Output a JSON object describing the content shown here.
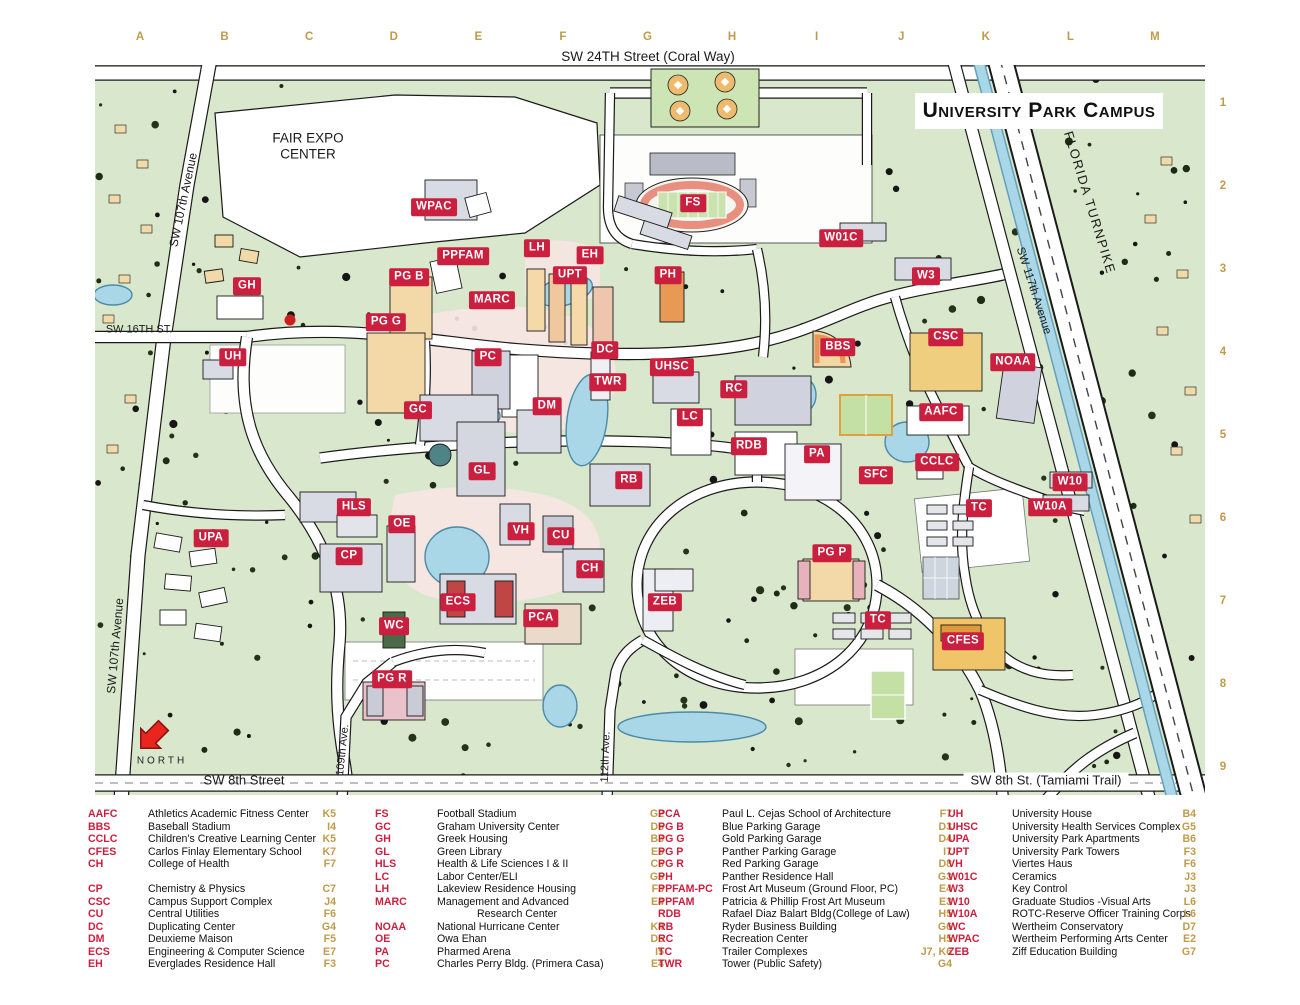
{
  "title_box": "University Park Campus",
  "top_street": "SW 24TH Street (Coral Way)",
  "north": {
    "label": "NORTH"
  },
  "colors": {
    "badge_red": "#cb1f3f",
    "grid_gold": "#bf9b4a",
    "map_green": "#d9e8cc",
    "water": "#a9d7e8",
    "road": "#ffffff"
  },
  "grid": {
    "letters": [
      "A",
      "B",
      "C",
      "D",
      "E",
      "F",
      "G",
      "H",
      "I",
      "J",
      "K",
      "L",
      "M"
    ],
    "numbers": [
      "1",
      "2",
      "3",
      "4",
      "5",
      "6",
      "7",
      "8",
      "9"
    ]
  },
  "map_labels": [
    {
      "t": "WPAC",
      "x": 434,
      "y": 207
    },
    {
      "t": "FS",
      "x": 693,
      "y": 203
    },
    {
      "t": "W01C",
      "x": 841,
      "y": 238
    },
    {
      "t": "LH",
      "x": 537,
      "y": 248
    },
    {
      "t": "PPFAM",
      "x": 463,
      "y": 256
    },
    {
      "t": "EH",
      "x": 590,
      "y": 255
    },
    {
      "t": "UPT",
      "x": 570,
      "y": 275
    },
    {
      "t": "PH",
      "x": 668,
      "y": 275
    },
    {
      "t": "W3",
      "x": 926,
      "y": 276
    },
    {
      "t": "GH",
      "x": 247,
      "y": 286
    },
    {
      "t": "PG B",
      "x": 409,
      "y": 277
    },
    {
      "t": "MARC",
      "x": 492,
      "y": 300
    },
    {
      "t": "PG G",
      "x": 386,
      "y": 322
    },
    {
      "t": "CSC",
      "x": 946,
      "y": 337
    },
    {
      "t": "BBS",
      "x": 838,
      "y": 347
    },
    {
      "t": "DC",
      "x": 605,
      "y": 350
    },
    {
      "t": "PC",
      "x": 488,
      "y": 357
    },
    {
      "t": "UH",
      "x": 233,
      "y": 357
    },
    {
      "t": "NOAA",
      "x": 1013,
      "y": 362
    },
    {
      "t": "UHSC",
      "x": 672,
      "y": 367
    },
    {
      "t": "TWR",
      "x": 608,
      "y": 382
    },
    {
      "t": "RC",
      "x": 734,
      "y": 389
    },
    {
      "t": "GC",
      "x": 418,
      "y": 410
    },
    {
      "t": "DM",
      "x": 547,
      "y": 406
    },
    {
      "t": "AAFC",
      "x": 941,
      "y": 412
    },
    {
      "t": "LC",
      "x": 690,
      "y": 417
    },
    {
      "t": "RDB",
      "x": 749,
      "y": 446
    },
    {
      "t": "PA",
      "x": 817,
      "y": 454
    },
    {
      "t": "CCLC",
      "x": 937,
      "y": 462
    },
    {
      "t": "GL",
      "x": 482,
      "y": 471
    },
    {
      "t": "SFC",
      "x": 876,
      "y": 475
    },
    {
      "t": "RB",
      "x": 629,
      "y": 480
    },
    {
      "t": "W10",
      "x": 1070,
      "y": 482
    },
    {
      "t": "TC",
      "x": 979,
      "y": 508
    },
    {
      "t": "W10A",
      "x": 1050,
      "y": 507
    },
    {
      "t": "HLS",
      "x": 354,
      "y": 507
    },
    {
      "t": "OE",
      "x": 402,
      "y": 524
    },
    {
      "t": "VH",
      "x": 521,
      "y": 531
    },
    {
      "t": "CU",
      "x": 561,
      "y": 536
    },
    {
      "t": "UPA",
      "x": 211,
      "y": 538
    },
    {
      "t": "PG P",
      "x": 832,
      "y": 553
    },
    {
      "t": "CP",
      "x": 349,
      "y": 556
    },
    {
      "t": "CH",
      "x": 590,
      "y": 569
    },
    {
      "t": "ECS",
      "x": 458,
      "y": 602
    },
    {
      "t": "ZEB",
      "x": 665,
      "y": 602
    },
    {
      "t": "PCA",
      "x": 541,
      "y": 618
    },
    {
      "t": "TC",
      "x": 878,
      "y": 620
    },
    {
      "t": "WC",
      "x": 394,
      "y": 626
    },
    {
      "t": "CFES",
      "x": 963,
      "y": 641
    },
    {
      "t": "PG R",
      "x": 392,
      "y": 679
    }
  ],
  "street_labels": [
    {
      "t": "FAIR EXPO\nCENTER",
      "x": 308,
      "y": 146,
      "fs": 13.5,
      "n": "fair-expo-center-label"
    },
    {
      "t": "SW 107th Avenue",
      "x": 184,
      "y": 200,
      "r": -78,
      "fs": 12,
      "n": "sw-107th-avenue-label"
    },
    {
      "t": "SW 107th Avenue",
      "x": 116,
      "y": 646,
      "r": -85,
      "fs": 12,
      "n": "sw-107th-avenue-label-south"
    },
    {
      "t": "SW 16TH ST.",
      "x": 139,
      "y": 330,
      "fs": 11,
      "n": "sw-16th-st-label"
    },
    {
      "t": "SW 8th Street",
      "x": 244,
      "y": 781,
      "fs": 13,
      "n": "sw-8th-street-label"
    },
    {
      "t": "109th Ave.",
      "x": 343,
      "y": 750,
      "r": -84,
      "fs": 11,
      "n": "109th-ave-label"
    },
    {
      "t": "112th Ave.",
      "x": 606,
      "y": 757,
      "r": -88,
      "fs": 11,
      "n": "112th-ave-label"
    },
    {
      "t": "SW 8th St. (Tamiami Trail)",
      "x": 1046,
      "y": 781,
      "fs": 13,
      "bg": "#ffffff",
      "n": "tamiami-trail-label"
    },
    {
      "t": "SW 117th Avenue",
      "x": 1033,
      "y": 291,
      "r": 72,
      "fs": 11.5,
      "n": "sw-117th-avenue-label"
    },
    {
      "t": "FLORIDA TURNPIKE",
      "x": 1089,
      "y": 203,
      "r": 73,
      "fs": 13,
      "sp": 1.5,
      "n": "florida-turnpike-label"
    }
  ],
  "legend": {
    "columns": [
      [
        {
          "a": "AAFC",
          "n": "Athletics Academic Fitness Center",
          "g": "K5"
        },
        {
          "a": "BBS",
          "n": "Baseball Stadium",
          "g": "I4"
        },
        {
          "a": "CCLC",
          "n": "Children's Creative Learning Center",
          "g": "K5"
        },
        {
          "a": "CFES",
          "n": "Carlos Finlay Elementary School",
          "g": "K7"
        },
        {
          "a": "CH",
          "n": "College of Health",
          "g": "F7"
        },
        {
          "gap": true
        },
        {
          "a": "CP",
          "n": "Chemistry & Physics",
          "g": "C7"
        },
        {
          "a": "CSC",
          "n": "Campus Support Complex",
          "g": "J4"
        },
        {
          "a": "CU",
          "n": "Central Utilities",
          "g": "F6"
        },
        {
          "a": "DC",
          "n": "Duplicating Center",
          "g": "G4"
        },
        {
          "a": "DM",
          "n": "Deuxieme Maison",
          "g": "F5"
        },
        {
          "a": "ECS",
          "n": "Engineering & Computer Science",
          "g": "E7"
        },
        {
          "a": "EH",
          "n": "Everglades Residence Hall",
          "g": "F3"
        }
      ],
      [
        {
          "a": "FS",
          "n": "Football Stadium",
          "g": "G2"
        },
        {
          "a": "GC",
          "n": "Graham University Center",
          "g": "D5"
        },
        {
          "a": "GH",
          "n": "Greek Housing",
          "g": "B3"
        },
        {
          "a": "GL",
          "n": "Green Library",
          "g": "E5"
        },
        {
          "a": "HLS",
          "n": "Health & Life Sciences I & II",
          "g": "C6"
        },
        {
          "a": "LC",
          "n": "Labor Center/ELI",
          "g": "G5"
        },
        {
          "a": "LH",
          "n": "Lakeview Residence Housing",
          "g": "F3"
        },
        {
          "a": "MARC",
          "n": "Management and Advanced",
          "g": "E4"
        },
        {
          "n2": "Research Center"
        },
        {
          "a": "NOAA",
          "n": "National Hurricane Center",
          "g": "K4"
        },
        {
          "a": "OE",
          "n": "Owa Ehan",
          "g": "D6"
        },
        {
          "a": "PA",
          "n": "Pharmed Arena",
          "g": "I5"
        },
        {
          "a": "PC",
          "n": "Charles Perry Bldg. (Primera Casa)",
          "g": "E4"
        }
      ],
      [
        {
          "a": "PCA",
          "n": "Paul L. Cejas School of Architecture",
          "g": "F7"
        },
        {
          "a": "PG B",
          "n": "Blue Parking Garage",
          "g": "D3"
        },
        {
          "a": "PG G",
          "n": "Gold Parking Garage",
          "g": "D4"
        },
        {
          "a": "PG P",
          "n": "Panther Parking Garage",
          "g": "I7"
        },
        {
          "a": "PG R",
          "n": "Red Parking Garage",
          "g": "D8"
        },
        {
          "a": "PH",
          "n": "Panther Residence Hall",
          "g": "G3"
        },
        {
          "a": "PPFAM-PC",
          "n": "Frost Art Museum (Ground Floor, PC)",
          "g": "E4"
        },
        {
          "a": "PPFAM",
          "n": "Patricia & Phillip Frost Art Museum",
          "g": "E3"
        },
        {
          "a": "RDB",
          "n": "Rafael Diaz Balart Bldg",
          "s": "(College of Law)",
          "g": "H5"
        },
        {
          "a": "RB",
          "n": "Ryder Business Building",
          "g": "G6"
        },
        {
          "a": "RC",
          "n": "Recreation Center",
          "g": "H5"
        },
        {
          "a": "TC",
          "n": "Trailer Complexes",
          "g": "J7, K6"
        },
        {
          "a": "TWR",
          "n": "Tower (Public Safety)",
          "g": "G4"
        }
      ],
      [
        {
          "a": "UH",
          "n": "University House",
          "g": "B4"
        },
        {
          "a": "UHSC",
          "n": "University Health Services Complex",
          "g": "G5"
        },
        {
          "a": "UPA",
          "n": "University Park Apartments",
          "g": "B6"
        },
        {
          "a": "UPT",
          "n": "University Park Towers",
          "g": "F3"
        },
        {
          "a": "VH",
          "n": "Viertes Haus",
          "g": "F6"
        },
        {
          "a": "W01C",
          "n": "Ceramics",
          "g": "J3"
        },
        {
          "a": "W3",
          "n": "Key Control",
          "g": "J3"
        },
        {
          "a": "W10",
          "n": "Graduate Studios -Visual Arts",
          "g": "L6"
        },
        {
          "a": "W10A",
          "n": "ROTC-Reserve Officer Training Corps",
          "g": "L6"
        },
        {
          "a": "WC",
          "n": "Wertheim Conservatory",
          "g": "D7"
        },
        {
          "a": "WPAC",
          "n": "Wertheim Performing Arts Center",
          "g": "E2"
        },
        {
          "a": "ZEB",
          "n": "Ziff Education Building",
          "g": "G7"
        }
      ]
    ]
  }
}
